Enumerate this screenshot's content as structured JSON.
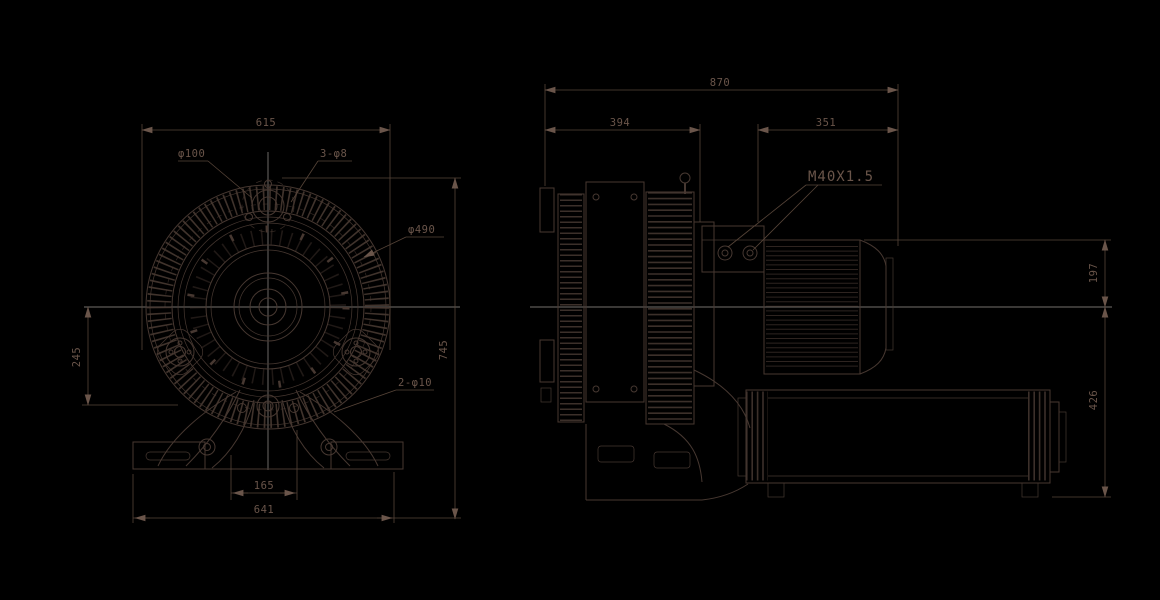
{
  "drawing_type": "engineering drawing - side channel blower, front and side views",
  "front_view": {
    "dims": {
      "width_top": "615",
      "height": "745",
      "center_to_base": "245",
      "port_spacing": "165",
      "base_width": "641"
    },
    "labels": {
      "inlet_diameter": "φ100",
      "inlet_bolts": "3-φ8",
      "housing_diameter": "φ490",
      "foot_holes": "2-φ10"
    }
  },
  "side_view": {
    "dims": {
      "total_length": "870",
      "housing_length": "394",
      "motor_length": "351",
      "height_above_center": "197",
      "height_below_center": "426"
    },
    "labels": {
      "cable_gland": "M40X1.5"
    }
  },
  "colors": {
    "background": "#000000",
    "line": "#473831",
    "dimension_line": "#564438",
    "text": "#6a554a",
    "centerline": "#b7b1ac"
  }
}
